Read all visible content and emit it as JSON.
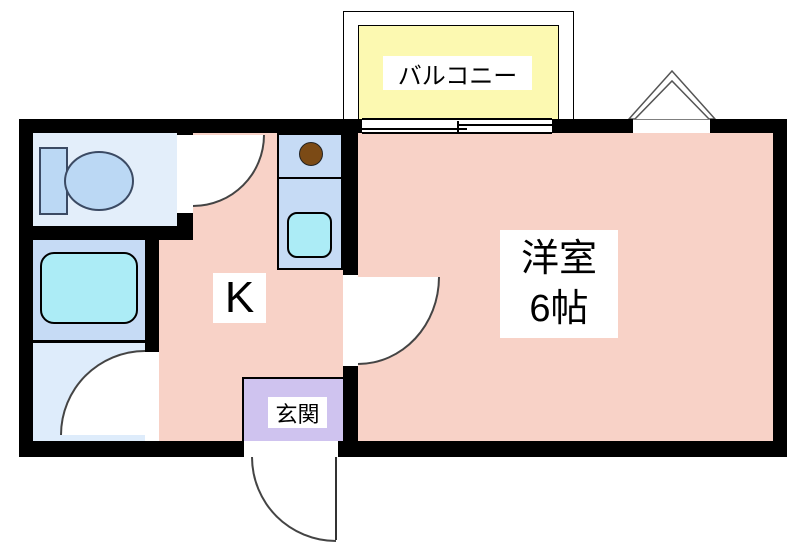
{
  "labels": {
    "balcony": "バルコニー",
    "kitchen": "K",
    "entrance": "玄関",
    "main_room_name": "洋室",
    "main_room_size": "6帖"
  },
  "colors": {
    "floor_pink": "#f8d2c7",
    "balcony_yellow": "#fcf9b1",
    "entrance_purple": "#cfc3ef",
    "toilet_floor": "#e3eefa",
    "bath_floor": "#c6dbf5",
    "washroom_floor": "#deecfb",
    "fixture_blue": "#bbd8f4",
    "tub_cyan": "#acecf6",
    "burner_brown": "#7b4a15",
    "wall_black": "#000000"
  }
}
